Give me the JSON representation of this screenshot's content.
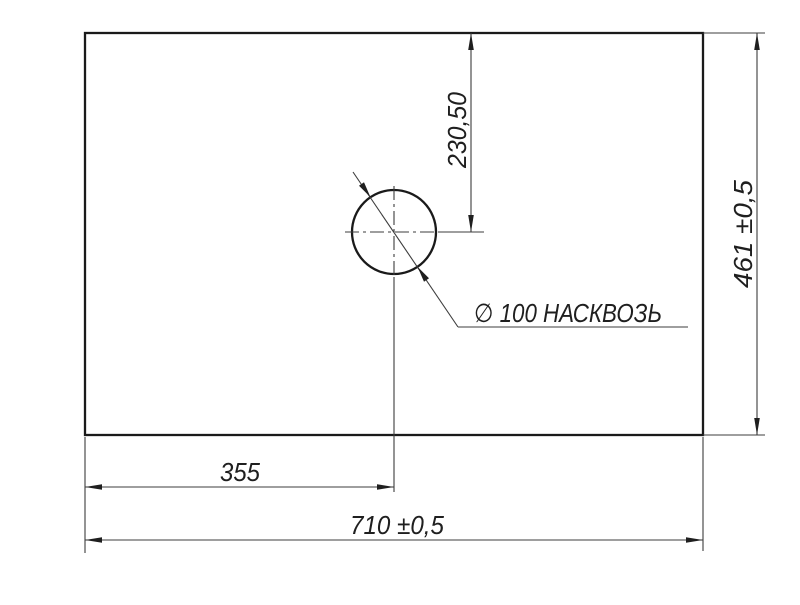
{
  "drawing": {
    "colors": {
      "background": "#ffffff",
      "contour_line": "#1a1a1a",
      "thin_line": "#3d3d3d",
      "text": "#1f1f1f"
    },
    "hole_callout": {
      "label": "∅ 100 НАСКВОЗЬ"
    },
    "dimensions": {
      "hole_center_from_top": "230,50",
      "panel_height": "461 ±0,5",
      "hole_center_from_left": "355",
      "panel_width": "710 ±0,5"
    }
  }
}
